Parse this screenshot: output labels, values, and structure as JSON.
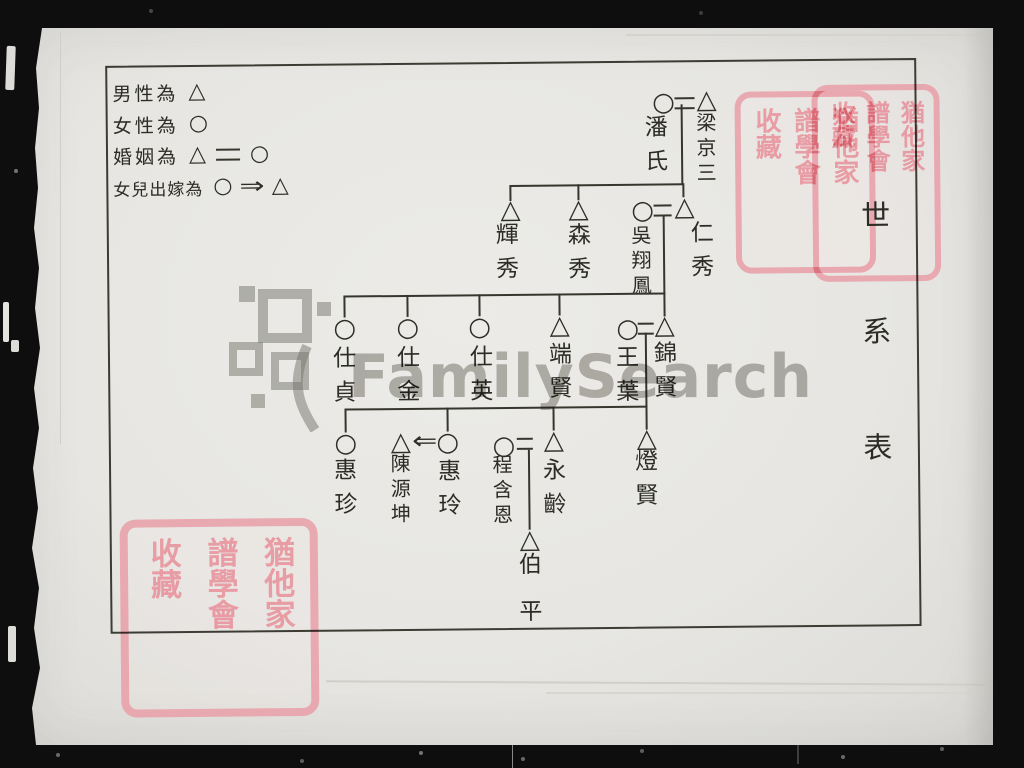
{
  "document": {
    "title_chars": [
      "世",
      "系",
      "表"
    ],
    "watermark_text": "FamilySearch"
  },
  "symbols": {
    "male": "△",
    "female": "○",
    "daughter_out_arrow": "⇒",
    "husband_in_arrow": "⇐"
  },
  "legend": {
    "items": [
      {
        "label": "男性為"
      },
      {
        "label": "女性為"
      },
      {
        "label": "婚姻為"
      },
      {
        "label": "女兒出嫁為"
      }
    ]
  },
  "tree": {
    "gen1": {
      "wife": "潘氏",
      "husband": "梁京三"
    },
    "gen2": {
      "son1": "輝秀",
      "son2": "森秀",
      "son3_wife": "吳翔鳳",
      "son3": "仁秀"
    },
    "gen3": {
      "dau1": "仕貞",
      "dau2": "仕金",
      "dau3": "仕英",
      "son1": "端賢",
      "son2_wife": "王葉",
      "son2": "錦賢"
    },
    "gen4": {
      "dau1": "惠珍",
      "dau2_husband": "陳源坤",
      "dau2": "惠玲",
      "son1_wife": "程含恩",
      "son1": "永齡",
      "son2": "燈賢"
    },
    "gen5": {
      "son1": "伯平"
    }
  },
  "seal": {
    "columns": [
      "猶他家",
      "譜學會",
      "收藏"
    ]
  }
}
